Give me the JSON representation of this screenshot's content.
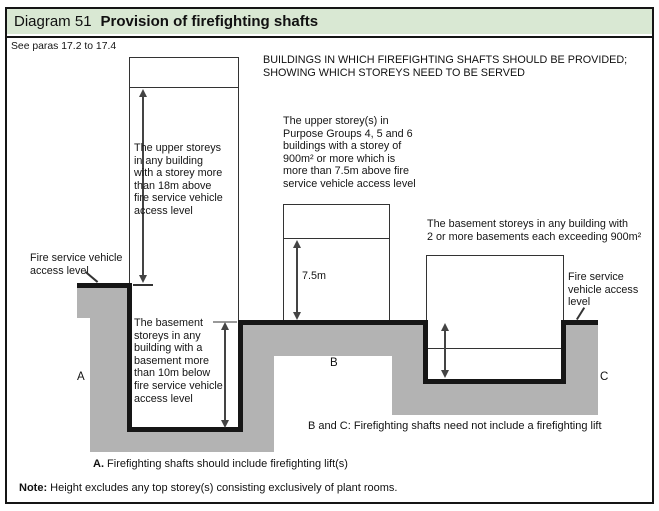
{
  "colors": {
    "header_bg": "#d9e8d3",
    "ground": "#b3b3b3",
    "line": "#151515"
  },
  "header": {
    "number": "Diagram 51",
    "title": "Provision of firefighting shafts"
  },
  "reference": "See paras 17.2 to 17.4",
  "top_caption": "BUILDINGS IN WHICH FIREFIGHTING SHAFTS SHOULD BE PROVIDED;\nSHOWING WHICH STOREYS NEED TO BE SERVED",
  "access_level_left": "Fire service vehicle\naccess level",
  "access_level_right": "Fire service\nvehicle access\nlevel",
  "building_a": {
    "upper_annotation": "The upper storeys\nin any building\nwith a storey more\nthan 18m above\nfire service vehicle\naccess level",
    "basement_annotation": "The basement\nstoreys in any\nbuilding with a\nbasement more\nthan 10m below\nfire service vehicle\naccess level",
    "label": "A"
  },
  "building_b": {
    "annotation": "The upper storey(s) in\nPurpose Groups 4, 5 and 6\nbuildings with a storey of\n900m² or more which is\nmore than 7.5m above fire\nservice vehicle access level",
    "height_label": "7.5m",
    "label": "B"
  },
  "building_c": {
    "annotation": "The basement storeys in any building with\n2 or more basements each exceeding 900m²",
    "label": "C"
  },
  "captions": {
    "a_prefix": "A.",
    "a_text": " Firefighting shafts should include firefighting lift(s)",
    "bc": "B and C: Firefighting shafts need not include a firefighting lift",
    "note_prefix": "Note:",
    "note_text": " Height excludes any top storey(s) consisting exclusively of plant rooms."
  }
}
